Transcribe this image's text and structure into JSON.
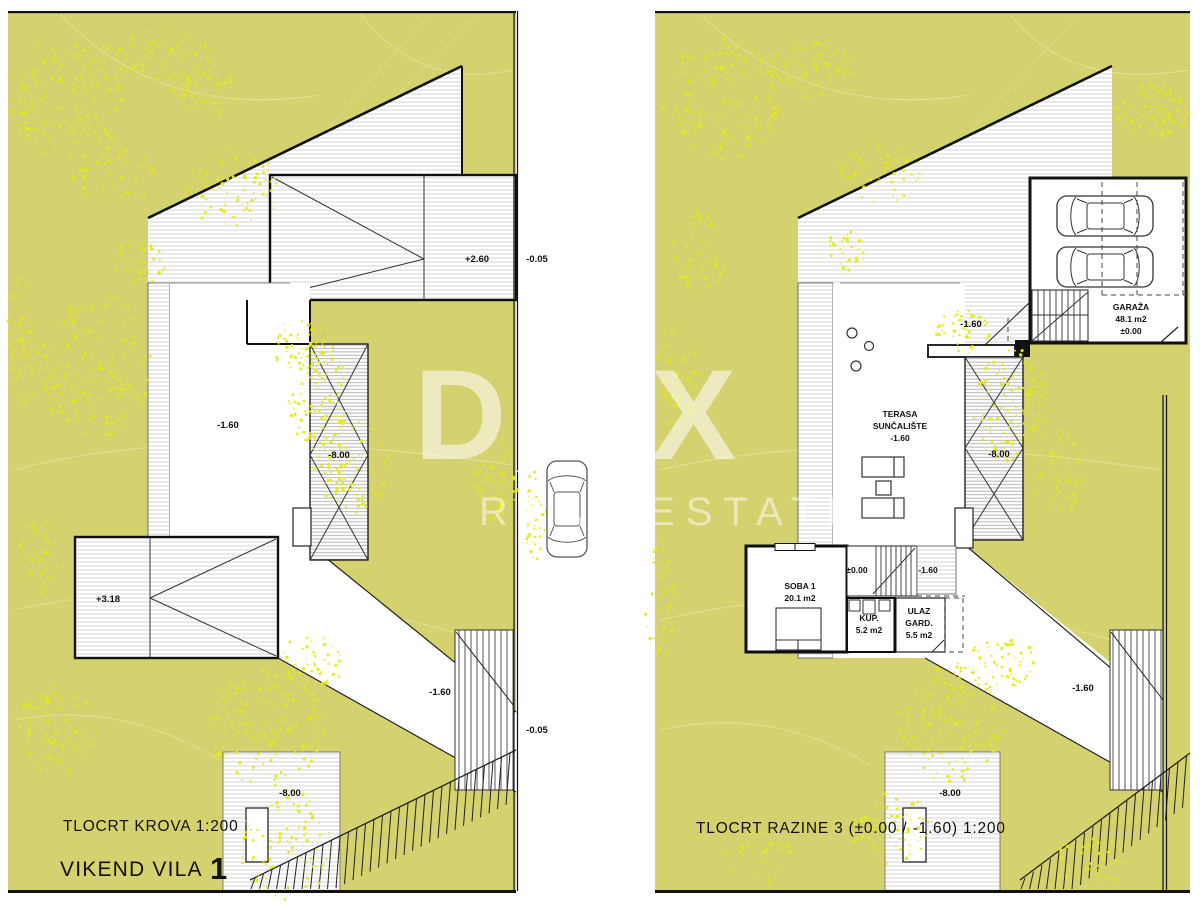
{
  "colors": {
    "terrain": "#d4d16f",
    "speckle": "#e6ea14",
    "linework": "#151515",
    "hatch": "#c9c9c9",
    "watermark": "rgba(255,255,255,0.55)"
  },
  "watermark": {
    "brand": "DUX",
    "tagline": "REAL ESTATE"
  },
  "glyphs": {
    "divider_car": "car-top-view",
    "garage_cars": "car-top-view"
  },
  "left": {
    "title": "TLOCRT KROVA 1:200",
    "project": "VIKEND VILA",
    "project_no": "1",
    "lbl": {
      "roof_high": "+2.60",
      "road_top": "-0.05",
      "court": "-1.60",
      "wall_top": "-8.00",
      "roof_low": "+3.18",
      "path": "-1.60",
      "road_bottom": "-0.05",
      "wall_bottom": "-8.00"
    }
  },
  "right": {
    "title": "TLOCRT RAZINE 3 (±0.00 / -1.60) 1:200",
    "garage": {
      "name": "GARAŽA",
      "area": "48.1 m2",
      "level": "±0.00"
    },
    "terrace": {
      "l1": "TERASA",
      "l2": "SUNČALIŠTE",
      "level": "-1.60"
    },
    "soba": {
      "name": "SOBA 1",
      "area": "20.1 m2"
    },
    "kup": {
      "name": "KUP.",
      "area": "5.2 m2"
    },
    "ulaz": {
      "l1": "ULAZ",
      "l2": "GARD.",
      "area": "5.5 m2"
    },
    "lbl": {
      "court": "-1.60",
      "wall_top": "-8.00",
      "stair_top": "±0.00",
      "stair_bottom": "-1.60",
      "path": "-1.60",
      "wall_bottom": "-8.00"
    }
  }
}
